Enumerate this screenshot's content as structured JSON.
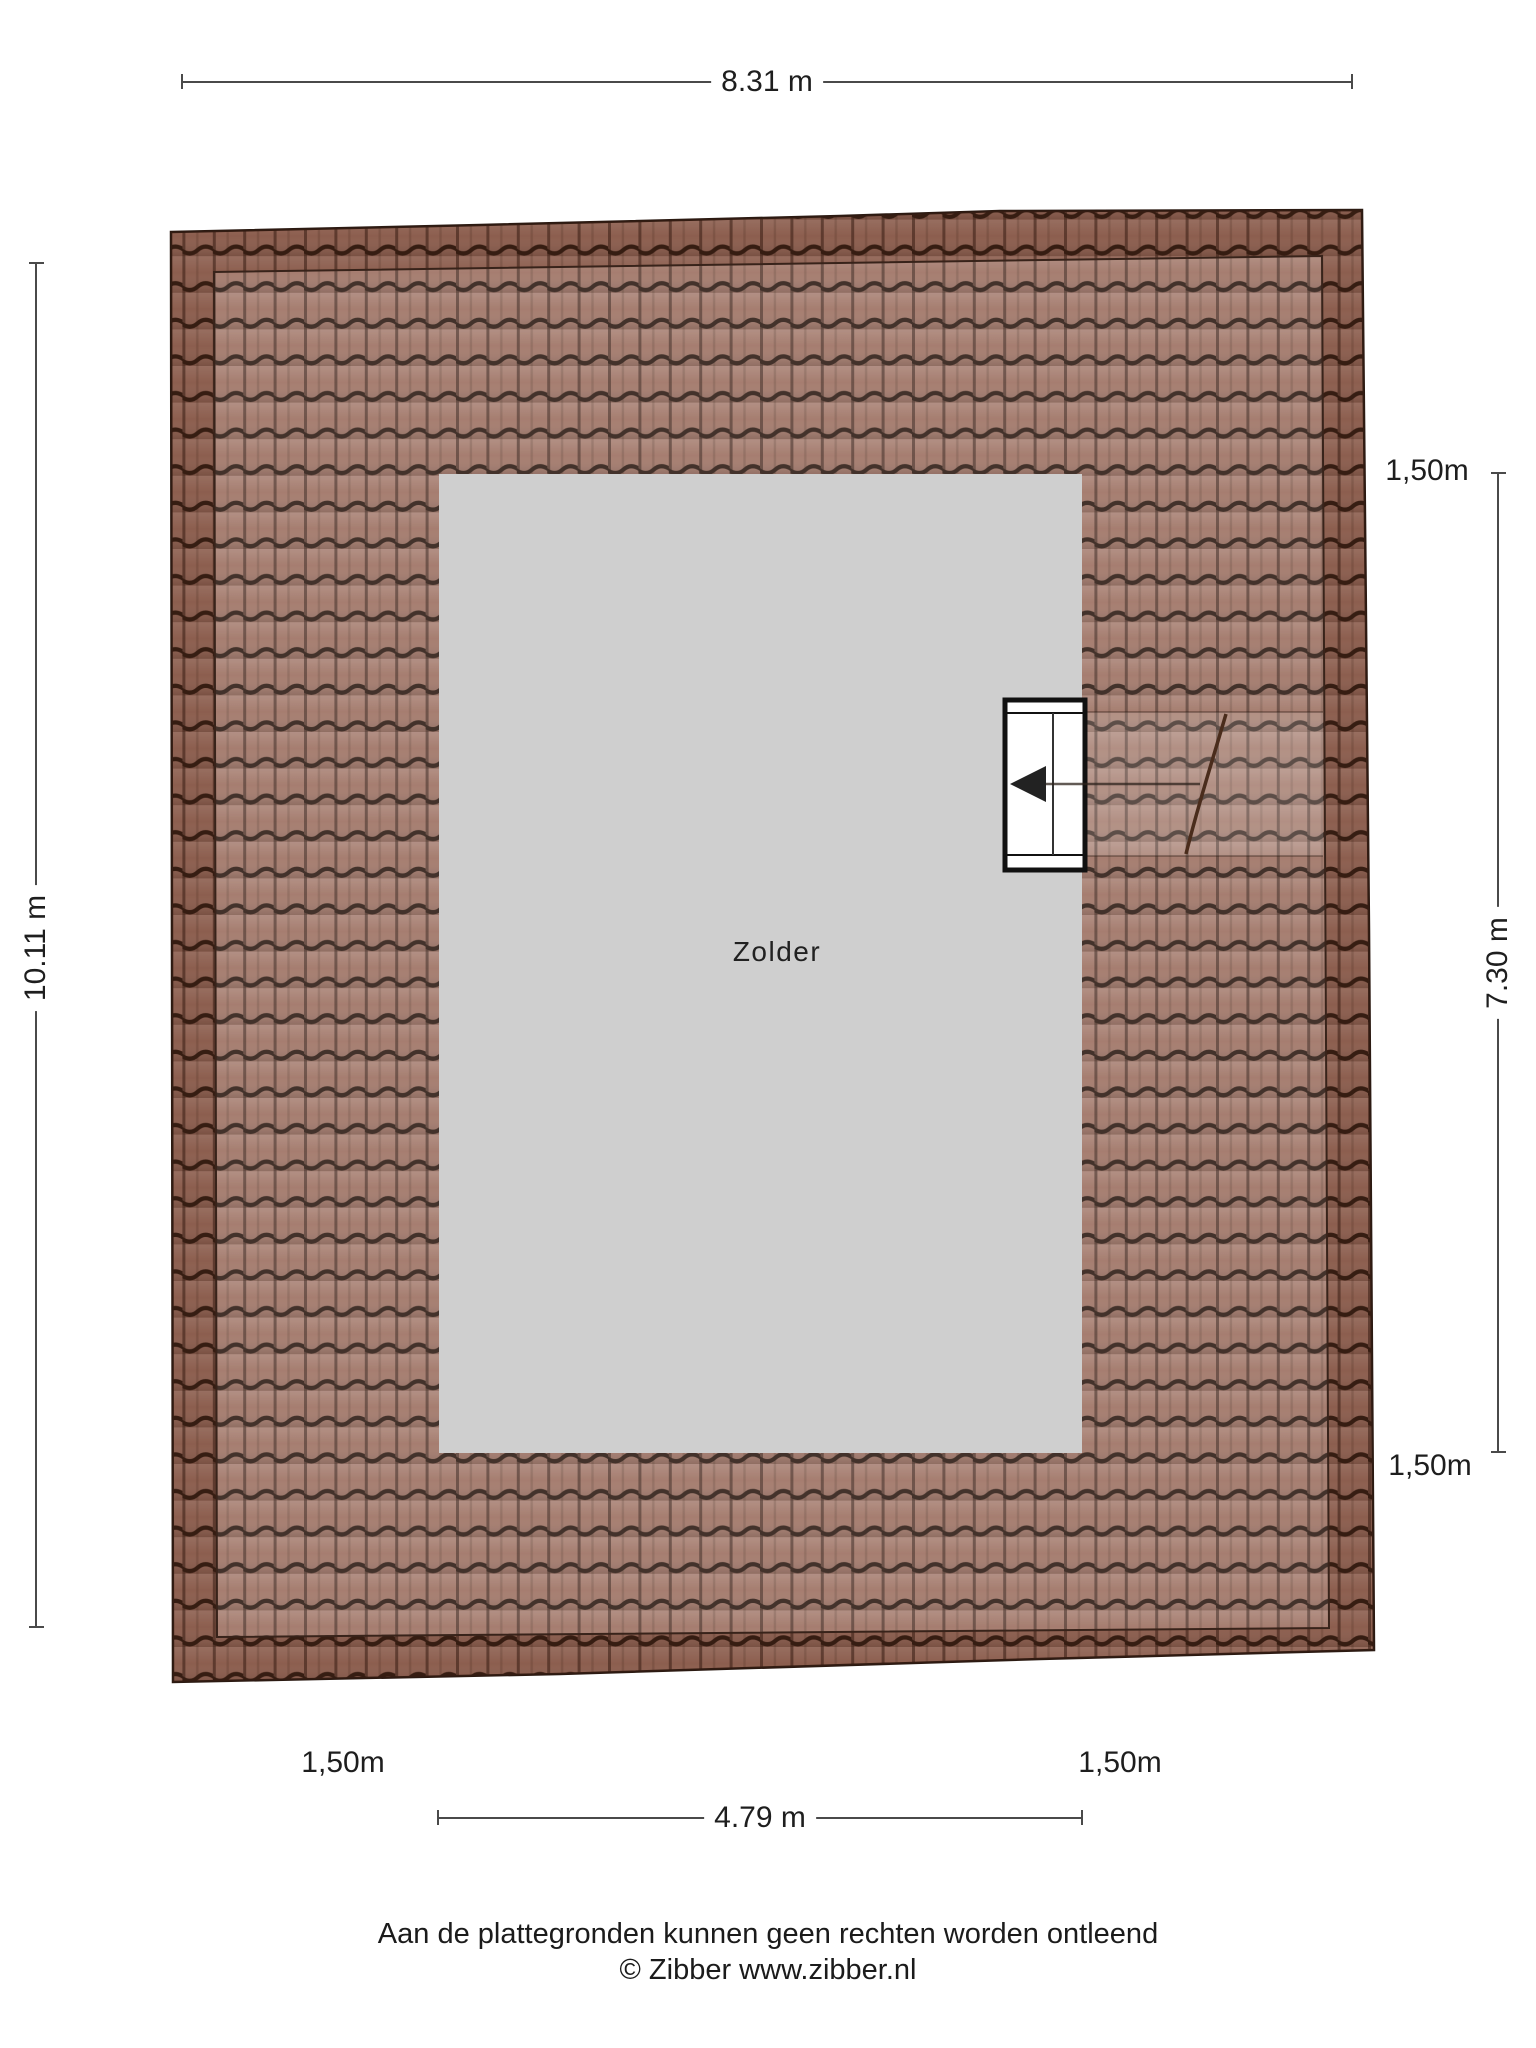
{
  "room": {
    "label": "Zolder"
  },
  "dims": {
    "top_width": "8.31 m",
    "left_height": "10.11 m",
    "right_height": "7.30 m",
    "inner_width": "4.79 m",
    "right_top_offset": "1,50m",
    "right_bottom_offset": "1,50m",
    "bottom_left_offset": "1,50m",
    "bottom_right_offset": "1,50m"
  },
  "footer": {
    "disclaimer": "Aan de plattegronden kunnen geen rechten worden ontleend",
    "copyright": "© Zibber www.zibber.nl"
  },
  "colors": {
    "roof_tile": "#9c6f60",
    "roof_gap_dark": "#2e1b13",
    "roof_edge_band": "rgba(88,38,16,0.22)",
    "room_fill": "#cfcfcf",
    "dimension_line": "#4a4a4a",
    "text": "#1e1e1e"
  }
}
